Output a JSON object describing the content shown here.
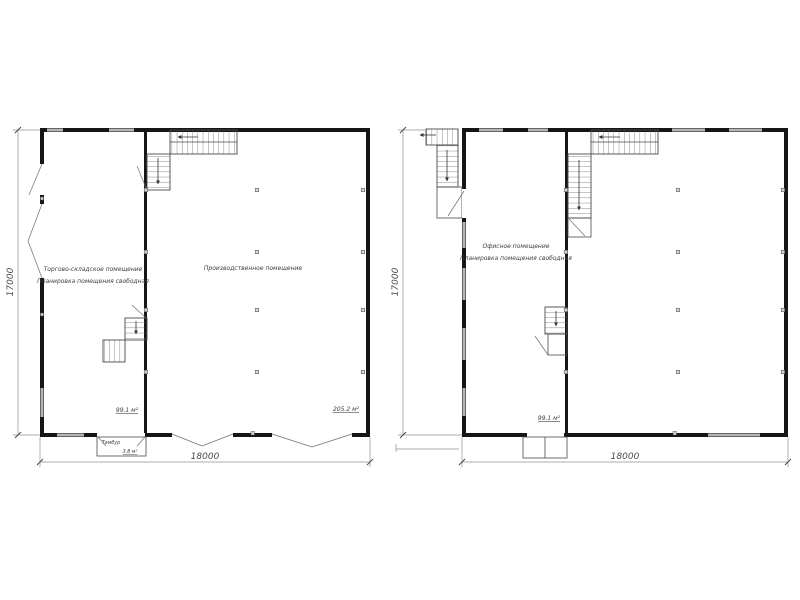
{
  "colors": {
    "background": "#ffffff",
    "wall": "#161616",
    "window": "#b5b5b5",
    "stair_line": "#4a4a4a",
    "dimension_line": "#909090",
    "text": "#3f3f3f"
  },
  "plan_left": {
    "rooms": {
      "left": {
        "line1": "Торгово-складское помещение",
        "line2": "Планировка помещения свободная",
        "area": "99.1 м²"
      },
      "right": {
        "label": "Производственное помещение",
        "area": "205.2 м²"
      }
    },
    "vestibule": {
      "label": "Тамбур",
      "area": "3.8 м²"
    },
    "dims": {
      "height": "17000",
      "width": "18000"
    }
  },
  "plan_right": {
    "rooms": {
      "left": {
        "line1": "Офисное помещение",
        "line2": "Планировка помещения свободная",
        "area": "99.1 м²"
      }
    },
    "dims": {
      "height": "17000",
      "width": "18000"
    }
  }
}
